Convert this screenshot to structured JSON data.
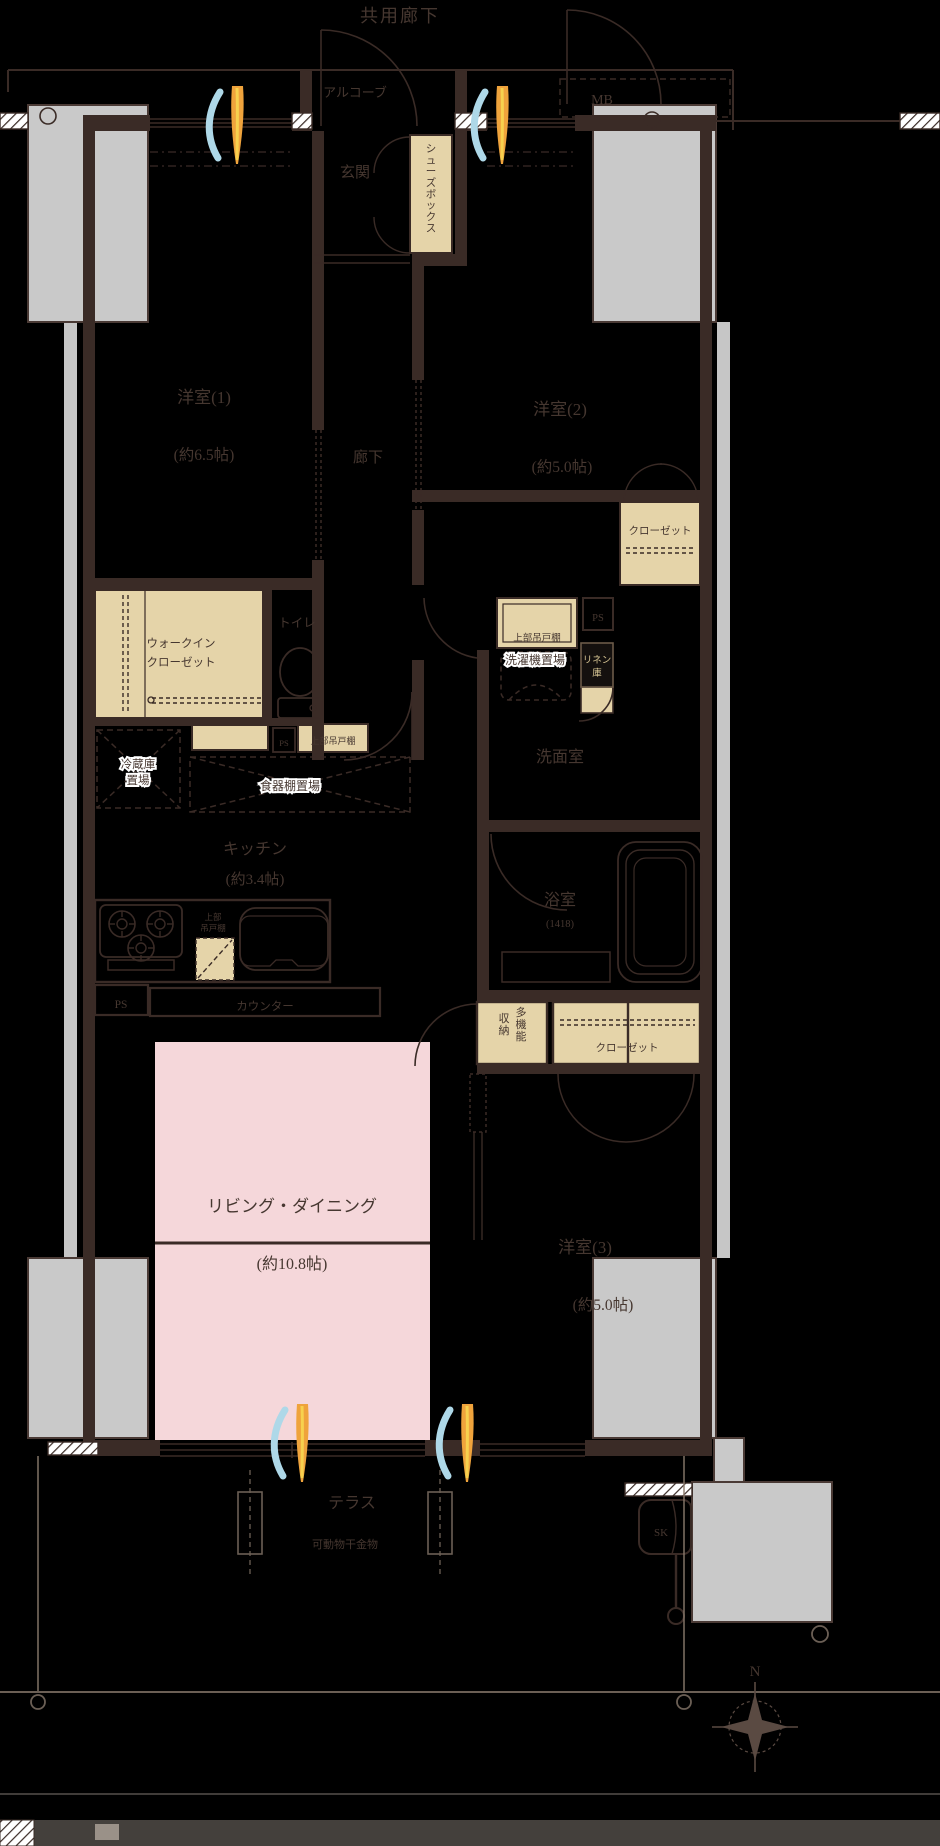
{
  "colors": {
    "background": "#000000",
    "wall": "#3a2b26",
    "storage_beige": "#e5d4a9",
    "living_pink": "#f5d7da",
    "pillar_gray": "#c9c9c9",
    "text": "#463730",
    "halo_white": "#ffffff",
    "wind_blue": "#aed8e8",
    "wind_orange": "#efa33c",
    "wind_yellow": "#f7d14e"
  },
  "top": {
    "common_corridor": "共用廊下",
    "alcove": "アルコーブ",
    "mb": "MB"
  },
  "entrance": {
    "genkan": "玄関",
    "shoe_box": "シューズボックス"
  },
  "hall": {
    "label": "廊下"
  },
  "room1": {
    "name": "洋室(1)",
    "size": "(約6.5帖)"
  },
  "room2": {
    "name": "洋室(2)",
    "size": "(約5.0帖)"
  },
  "room3": {
    "name": "洋室(3)",
    "size": "(約5.0帖)"
  },
  "living": {
    "name": "リビング・ダイニング",
    "size": "(約10.8帖)"
  },
  "kitchen": {
    "name": "キッチン",
    "size": "(約3.4帖)",
    "counter": "カウンター",
    "fridge_1": "冷蔵庫",
    "fridge_2": "置場",
    "cupboard": "食器棚置場",
    "upper_cabinet_1": "上部",
    "upper_cabinet_2": "吊戸棚",
    "ps": "PS"
  },
  "bath": {
    "name": "浴室",
    "size": "(1418)"
  },
  "washroom": {
    "name": "洗面室",
    "washer": "洗濯機置場",
    "upper_cabinet": "上部吊戸棚",
    "linen_1": "リネン",
    "linen_2": "庫",
    "ps": "PS"
  },
  "toilet": {
    "name": "トイレ",
    "upper_cabinet": "上部吊戸棚",
    "ps": "PS"
  },
  "storage": {
    "wic_1": "ウォークイン",
    "wic_2": "クローゼット",
    "closet2": "クローゼット",
    "closet3": "クローゼット",
    "multi_1": "多機能",
    "multi_2": "収納"
  },
  "terrace": {
    "name": "テラス",
    "laundry_hardware": "可動物干金物",
    "sk": "SK"
  },
  "compass": {
    "north": "N"
  }
}
